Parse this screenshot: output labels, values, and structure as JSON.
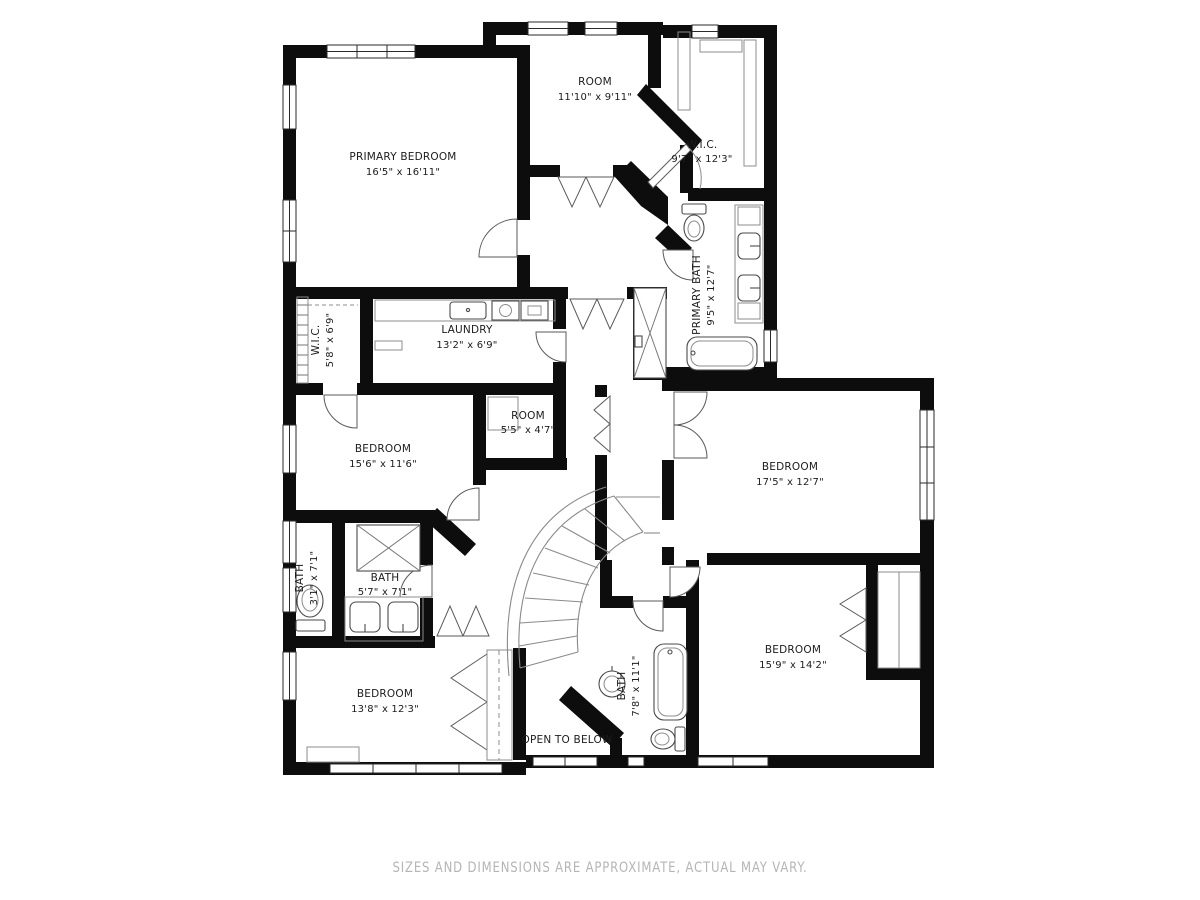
{
  "colors": {
    "wall": "#0d0d0d",
    "fixture_line": "#4a4a4a",
    "stair_line": "#8a8a8a",
    "label": "#1c1c1c",
    "disclaimer": "#b5b5b5",
    "background": "#ffffff"
  },
  "disclaimer": "SIZES AND DIMENSIONS ARE APPROXIMATE, ACTUAL MAY VARY.",
  "rooms": {
    "primary_bedroom": {
      "name": "PRIMARY BEDROOM",
      "dims": "16'5\" x 16'11\""
    },
    "room_top": {
      "name": "ROOM",
      "dims": "11'10\" x 9'11\""
    },
    "wic_top": {
      "name": "W.I.C.",
      "dims": "9'7\" x 12'3\""
    },
    "primary_bath": {
      "name": "PRIMARY BATH",
      "dims": "9'5\" x 12'7\""
    },
    "wic_left": {
      "name": "W.I.C.",
      "dims": "5'8\" x 6'9\""
    },
    "laundry": {
      "name": "LAUNDRY",
      "dims": "13'2\" x 6'9\""
    },
    "room_small": {
      "name": "ROOM",
      "dims": "5'5\" x 4'7\""
    },
    "bedroom_mid": {
      "name": "BEDROOM",
      "dims": "15'6\" x 11'6\""
    },
    "bedroom_right": {
      "name": "BEDROOM",
      "dims": "17'5\" x 12'7\""
    },
    "bath_left": {
      "name": "BATH",
      "dims": "3'1\" x 7'1\""
    },
    "bath_mid": {
      "name": "BATH",
      "dims": "5'7\" x 7'1\""
    },
    "bedroom_bl": {
      "name": "BEDROOM",
      "dims": "13'8\" x 12'3\""
    },
    "bath_bottom": {
      "name": "BATH",
      "dims": "7'8\" x 11'1\""
    },
    "bedroom_br": {
      "name": "BEDROOM",
      "dims": "15'9\" x 14'2\""
    },
    "open_below": {
      "name": "OPEN TO BELOW"
    }
  }
}
